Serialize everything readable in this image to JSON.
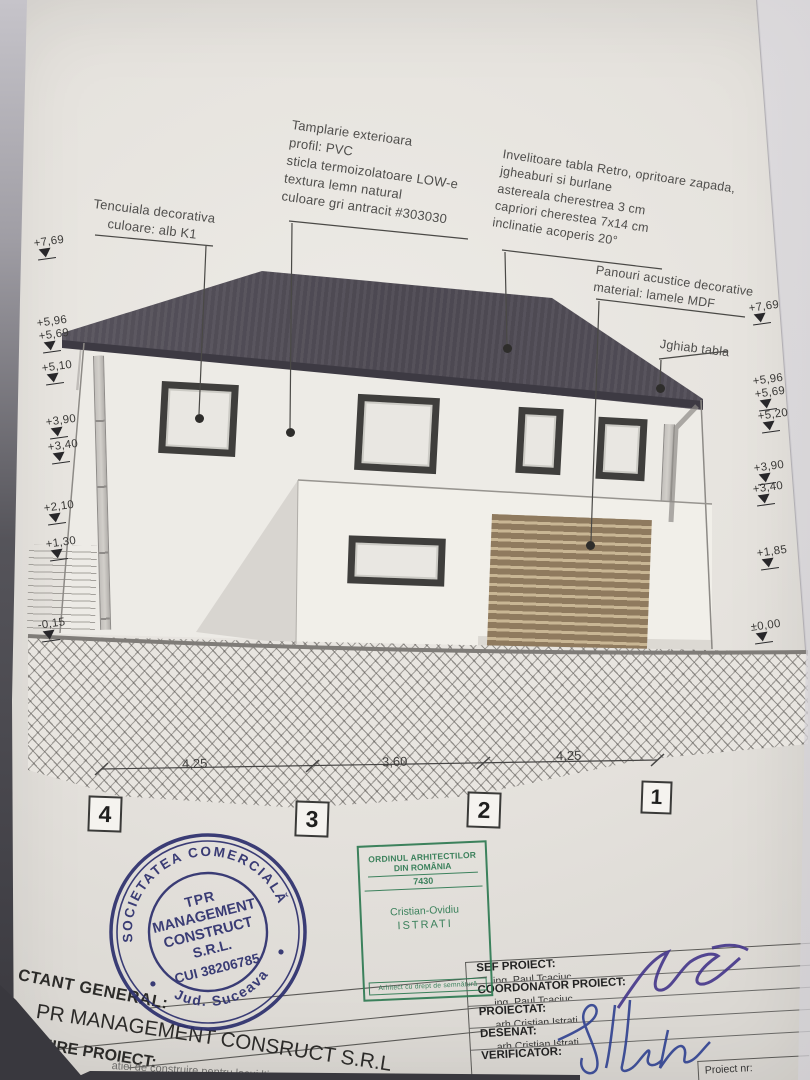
{
  "colors": {
    "paper": "#e6e3de",
    "roof": "#4e4a53",
    "lamella_brown": "#8f7a5e",
    "stamp_navy": "#2c2f6d",
    "stamp_green": "#2e7a52",
    "ink_violet": "#43348a",
    "ink_blue": "#2e3f8f"
  },
  "annotations": {
    "tencuiala": "Tencuiala decorativa\nculoare: alb K1",
    "tamplarie": "Tamplarie exterioara\nprofil: PVC\nsticla termoizolatoare LOW-e\ntextura lemn natural\nculoare gri antracit #303030",
    "invelitoare": "Invelitoare tabla Retro, opritoare zapada,\njgheaburi si burlane\nastereala cherestrea 3 cm\ncapriori cherestea 7x14 cm\ninclinatie acoperis 20°",
    "panouri": "Panouri acustice decorative\nmaterial: lamele MDF",
    "jghiab": "Jghiab tabla"
  },
  "elevation_markers": {
    "left": [
      "+7,69",
      "+5,96",
      "+5,69",
      "+5,10",
      "+3,90",
      "+3,40",
      "+2,10",
      "+1,30",
      "-0,15"
    ],
    "right": [
      "+7,69",
      "+5,96",
      "+5,69",
      "+5,20",
      "+3,90",
      "+3,40",
      "+1,85",
      "±0,00"
    ]
  },
  "dimensions": {
    "segments": [
      "4,25",
      "3,60",
      "4,25"
    ],
    "grid": [
      "4",
      "3",
      "2",
      "1"
    ]
  },
  "stamps": {
    "company": {
      "arc_top": "SOCIETATEA COMERCIALĂ",
      "arc_bottom": "Jud. Suceava",
      "line1": "TPR",
      "line2": "MANAGEMENT",
      "line3": "CONSTRUCT",
      "line4": "S.R.L.",
      "line5": "CUI 38206785"
    },
    "architect": {
      "org1": "ORDINUL ARHITECTILOR",
      "org2": "DIN ROMÂNIA",
      "number": "7430",
      "name1": "Cristian-Ovidiu",
      "name2": "ISTRATI",
      "footer": "Arhitect cu drept de semnătură"
    }
  },
  "title_block": {
    "left": {
      "row1": "CTANT GENERAL:",
      "row2": "PR MANAGEMENT CONSRUCT S.R.L",
      "row3": "MIRE PROIECT:",
      "note": "atiei de construire pentru locui                                     ltima, anexa gospodareasca si"
    },
    "right": {
      "rows": [
        {
          "label": "SEF PROIECT:",
          "value": "ing. Paul Tcaciuc"
        },
        {
          "label": "COORDONATOR PROIECT:",
          "value": "ing. Paul Tcaciuc"
        },
        {
          "label": "PROIECTAT:",
          "value": "arh.Cristian Istrati"
        },
        {
          "label": "DESENAT:",
          "value": "arh.Cristian Istrati"
        },
        {
          "label": "VERIFICATOR:",
          "value": ""
        }
      ],
      "proiect_nr": "Proiect nr:"
    }
  }
}
